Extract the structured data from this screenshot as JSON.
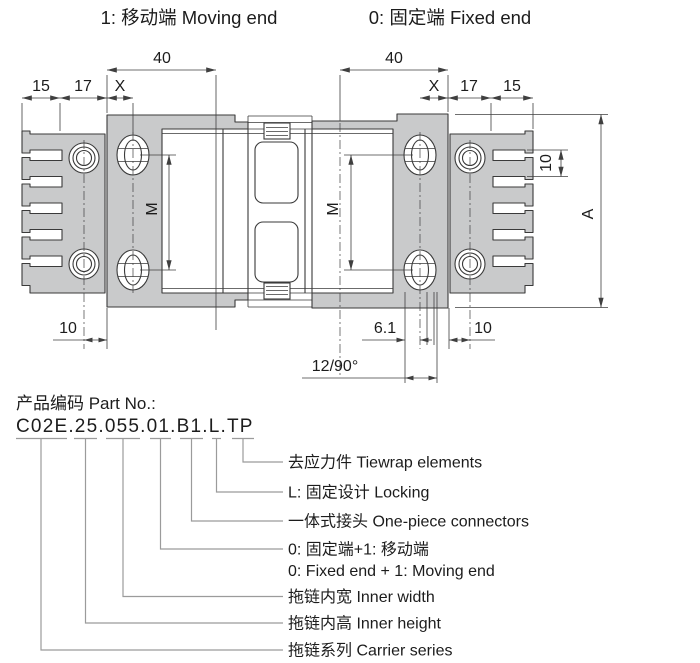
{
  "titles": {
    "moving_end": "1: 移动端 Moving end",
    "fixed_end": "0: 固定端 Fixed end"
  },
  "dimensions": {
    "moving_span": "40",
    "fixed_span": "40",
    "left_15": "15",
    "left_17": "17",
    "left_x": "X",
    "right_x": "X",
    "right_17": "17",
    "right_15": "15",
    "moving_slot_spacing": "M",
    "fixed_slot_spacing": "M",
    "overall_height": "A",
    "tooth_pitch": "10",
    "bottom_left_offset": "10",
    "bottom_gap": "6.1",
    "bottom_right_offset": "10",
    "link_pitch_angle": "12/90°"
  },
  "part_number": {
    "heading": "产品编码 Part No.:",
    "code": "C02E.25.055.01.B1.L.TP"
  },
  "part_legend": [
    {
      "label": "去应力件 Tiewrap elements"
    },
    {
      "label": "L: 固定设计 Locking"
    },
    {
      "label": "一体式接头 One-piece connectors"
    },
    {
      "label": "0: 固定端+1: 移动端",
      "label2": "0: Fixed end + 1: Moving end"
    },
    {
      "label": "拖链内宽 Inner width"
    },
    {
      "label": "拖链内高 Inner height"
    },
    {
      "label": "拖链系列 Carrier series"
    }
  ],
  "colors": {
    "part_fill": "#c9cacb",
    "outline": "#3a3a3a",
    "leader": "#9b9b9b",
    "background": "#ffffff"
  }
}
